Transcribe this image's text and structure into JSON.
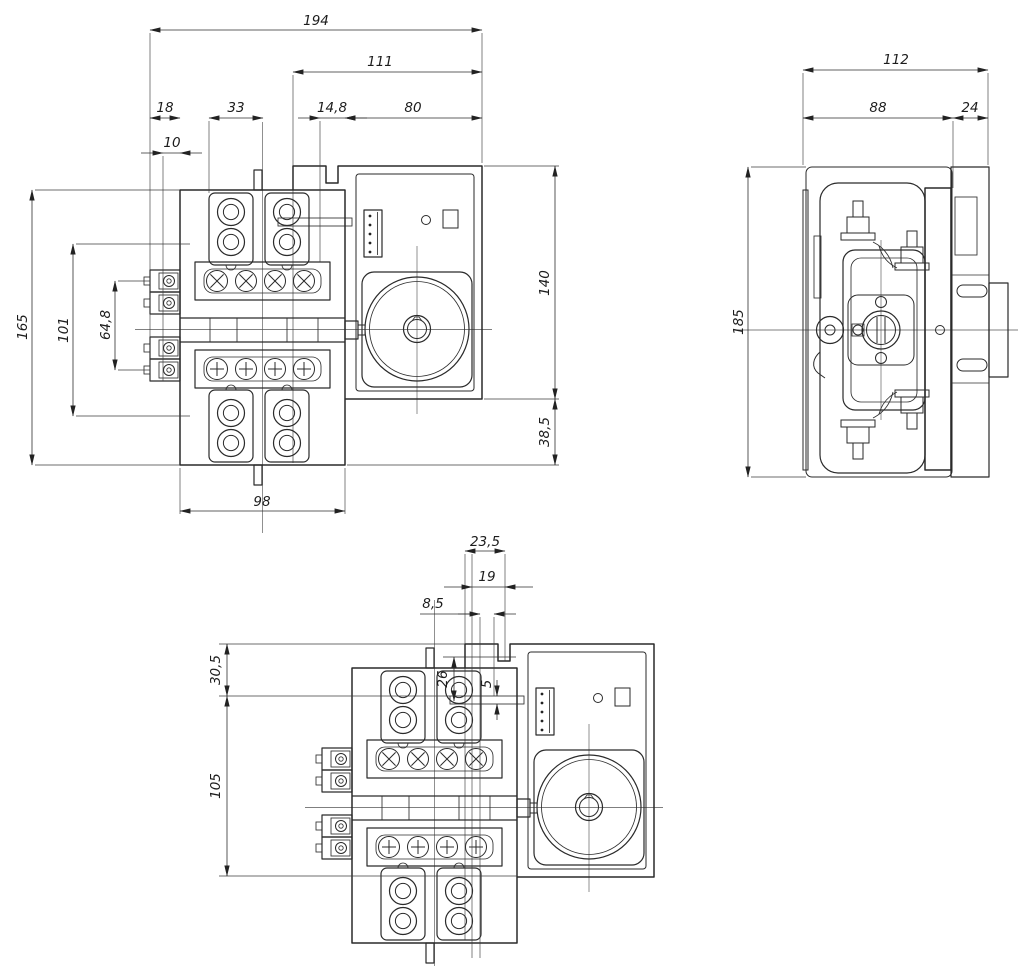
{
  "views": {
    "front": {
      "dims": {
        "overall_width": "194",
        "cover_width": "111",
        "left_terminal_width": "18",
        "pad_to_center": "33",
        "gap_width": "14,8",
        "box_width": "80",
        "terminal_screw_offset": "10",
        "overall_height": "165",
        "terminal_block_height": "101",
        "contact_pitch": "64,8",
        "box_height": "140",
        "base_extension": "38,5",
        "base_width": "98"
      }
    },
    "side": {
      "dims": {
        "overall_depth": "112",
        "body_depth": "88",
        "box_depth": "24",
        "overall_height": "185"
      }
    },
    "bottom": {
      "dims": {
        "cutout_width": "23,5",
        "slot_width": "19",
        "slot_offset": "8,5",
        "tab_depth": "26",
        "tab_thickness": "5",
        "top_offset": "30,5",
        "body_height": "105"
      }
    }
  }
}
